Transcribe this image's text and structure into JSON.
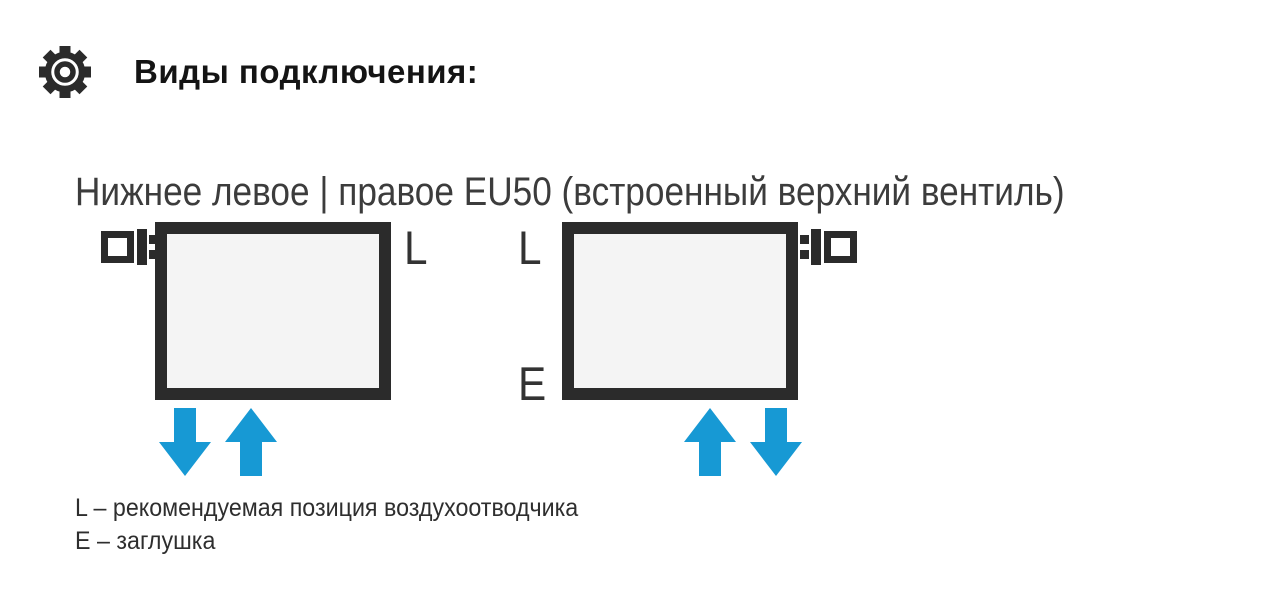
{
  "header": {
    "title": "Виды подключения:",
    "icon": "gear-icon"
  },
  "subtitle": "Нижнее левое | правое EU50 (встроенный верхний вентиль)",
  "diagrams": {
    "left": {
      "air_vent_label": "L",
      "valve_side": "top-left",
      "arrows": [
        "down",
        "up"
      ]
    },
    "right": {
      "air_vent_label": "L",
      "plug_label": "E",
      "valve_side": "top-right",
      "arrows": [
        "up",
        "down"
      ]
    }
  },
  "legend": {
    "line1": "L – рекомендуемая позиция воздухоотводчика",
    "line2": "E – заглушка"
  },
  "colors": {
    "dark": "#2b2b2b",
    "arrow_blue": "#1799d4",
    "radiator_fill": "#f4f4f4",
    "background": "#ffffff"
  }
}
